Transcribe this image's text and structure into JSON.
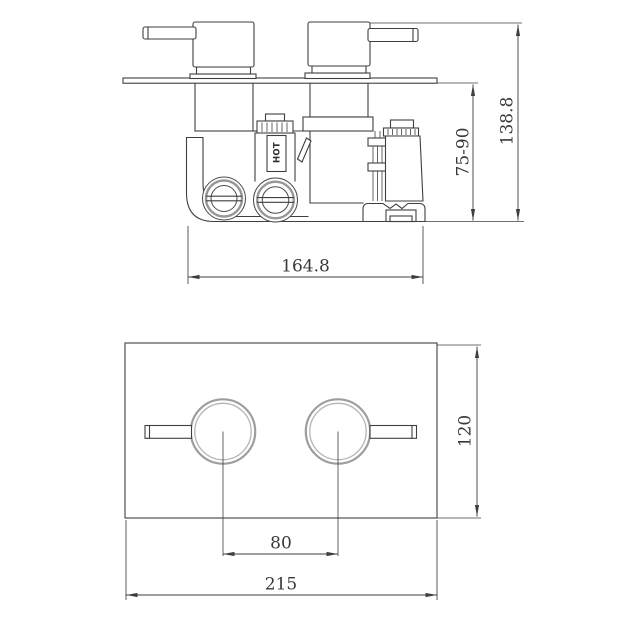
{
  "top_view": {
    "hot_indicator": "HOT",
    "dimensions": {
      "body_width": "164.8",
      "install_depth_range": "75-90",
      "overall_height": "138.8"
    }
  },
  "front_view": {
    "dimensions": {
      "handle_spacing": "80",
      "plate_width": "215",
      "plate_height": "120"
    }
  },
  "colors": {
    "line": "#3f3f3f",
    "dim_text": "#383838",
    "knob_ring": "#9b9ea0",
    "background": "#ffffff"
  }
}
